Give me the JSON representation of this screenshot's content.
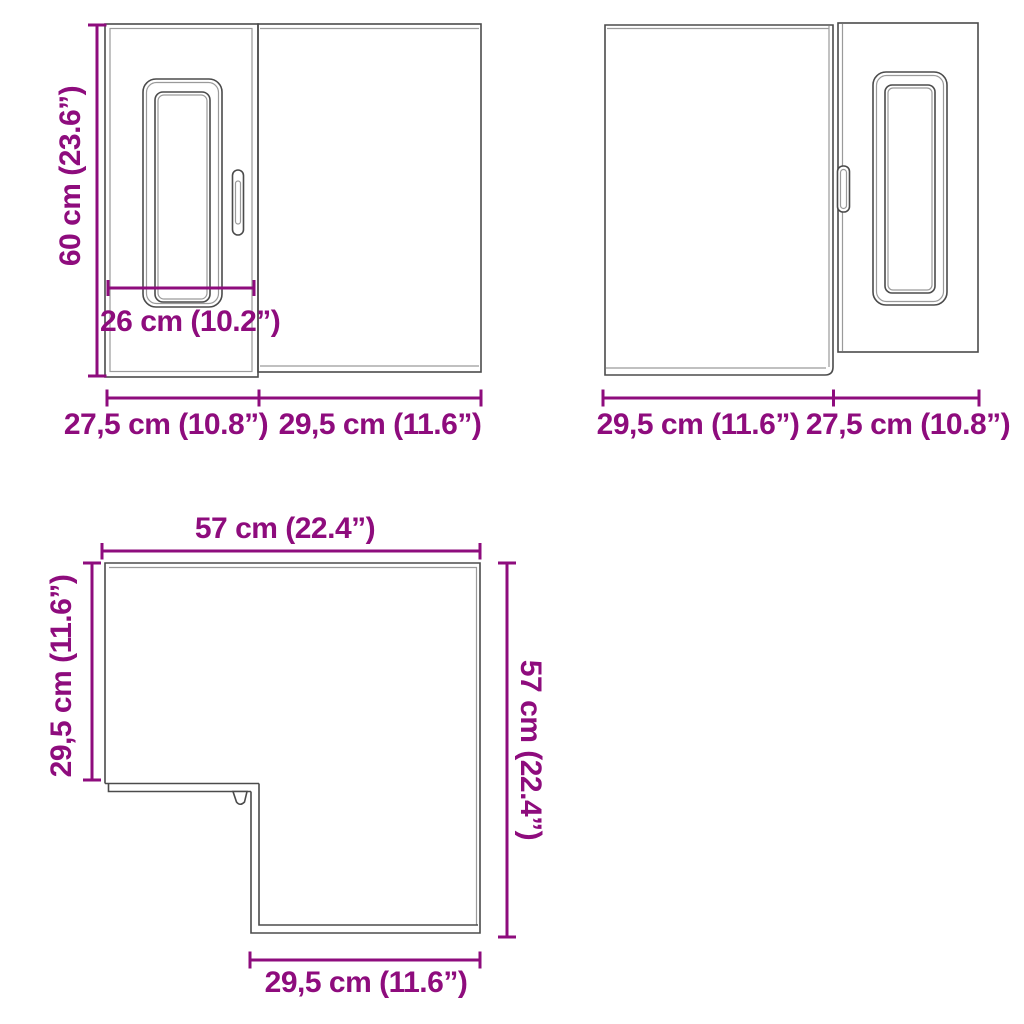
{
  "colors": {
    "accent": "#8E0C7D",
    "line": "#4B4B4B",
    "line_light": "#9A9A9A",
    "background": "#FFFFFF"
  },
  "views": {
    "front_left": {
      "height_label": "60 cm (23.6”)",
      "door_width_label": "26 cm (10.2”)",
      "bottom_left_width_label": "27,5 cm (10.8”)",
      "bottom_right_width_label": "29,5 cm (11.6”)"
    },
    "front_right": {
      "bottom_left_width_label": "29,5 cm (11.6”)",
      "bottom_right_width_label": "27,5 cm (10.8”)"
    },
    "plan": {
      "top_width_label": "57 cm (22.4”)",
      "left_depth_label": "29,5 cm (11.6”)",
      "right_depth_label": "57 cm (22.4”)",
      "bottom_width_label": "29,5 cm (11.6”)"
    }
  }
}
